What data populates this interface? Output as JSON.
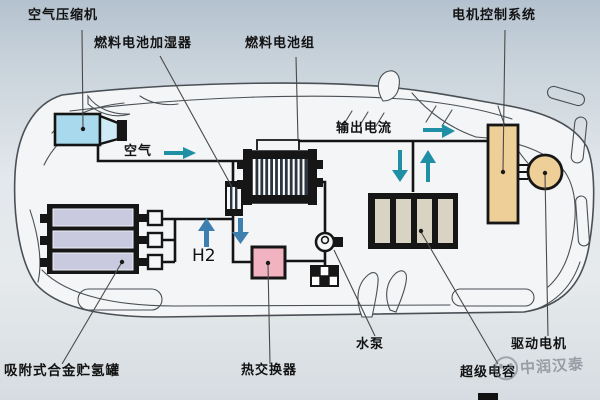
{
  "diagram": {
    "labels": {
      "air_compressor": "空气压缩机",
      "fuel_cell_humidifier": "燃料电池加湿器",
      "fuel_cell_stack": "燃料电池组",
      "motor_control_system": "电机控制系统",
      "output_current": "输出电流",
      "air": "空气",
      "hydrogen": "H2",
      "hydrogen_tank": "吸附式合金贮氢罐",
      "heat_exchanger": "热交换器",
      "water_pump": "水泵",
      "supercapacitor": "超级电容",
      "drive_motor": "驱动电机"
    },
    "colors": {
      "car_fill": "#f3f5f6",
      "car_line": "#4a5056",
      "pipe": "#141414",
      "compressor_fill": "#a9d9ec",
      "compressor_funnel_fill": "#cdeaf6",
      "tank_bar_fill": "#c9cadf",
      "stack_stripe": "#2a3640",
      "heat_exchanger_fill": "#f2b3c0",
      "supercap_bar_fill": "#d9d3c3",
      "controller_fill": "#eecf97",
      "motor_fill": "#eecf97",
      "teal_arrow": "#1f8fa6",
      "blue_arrow": "#3f7fb0",
      "leader": "#4a4a4a"
    },
    "watermark": {
      "text": "中润汉泰"
    }
  }
}
